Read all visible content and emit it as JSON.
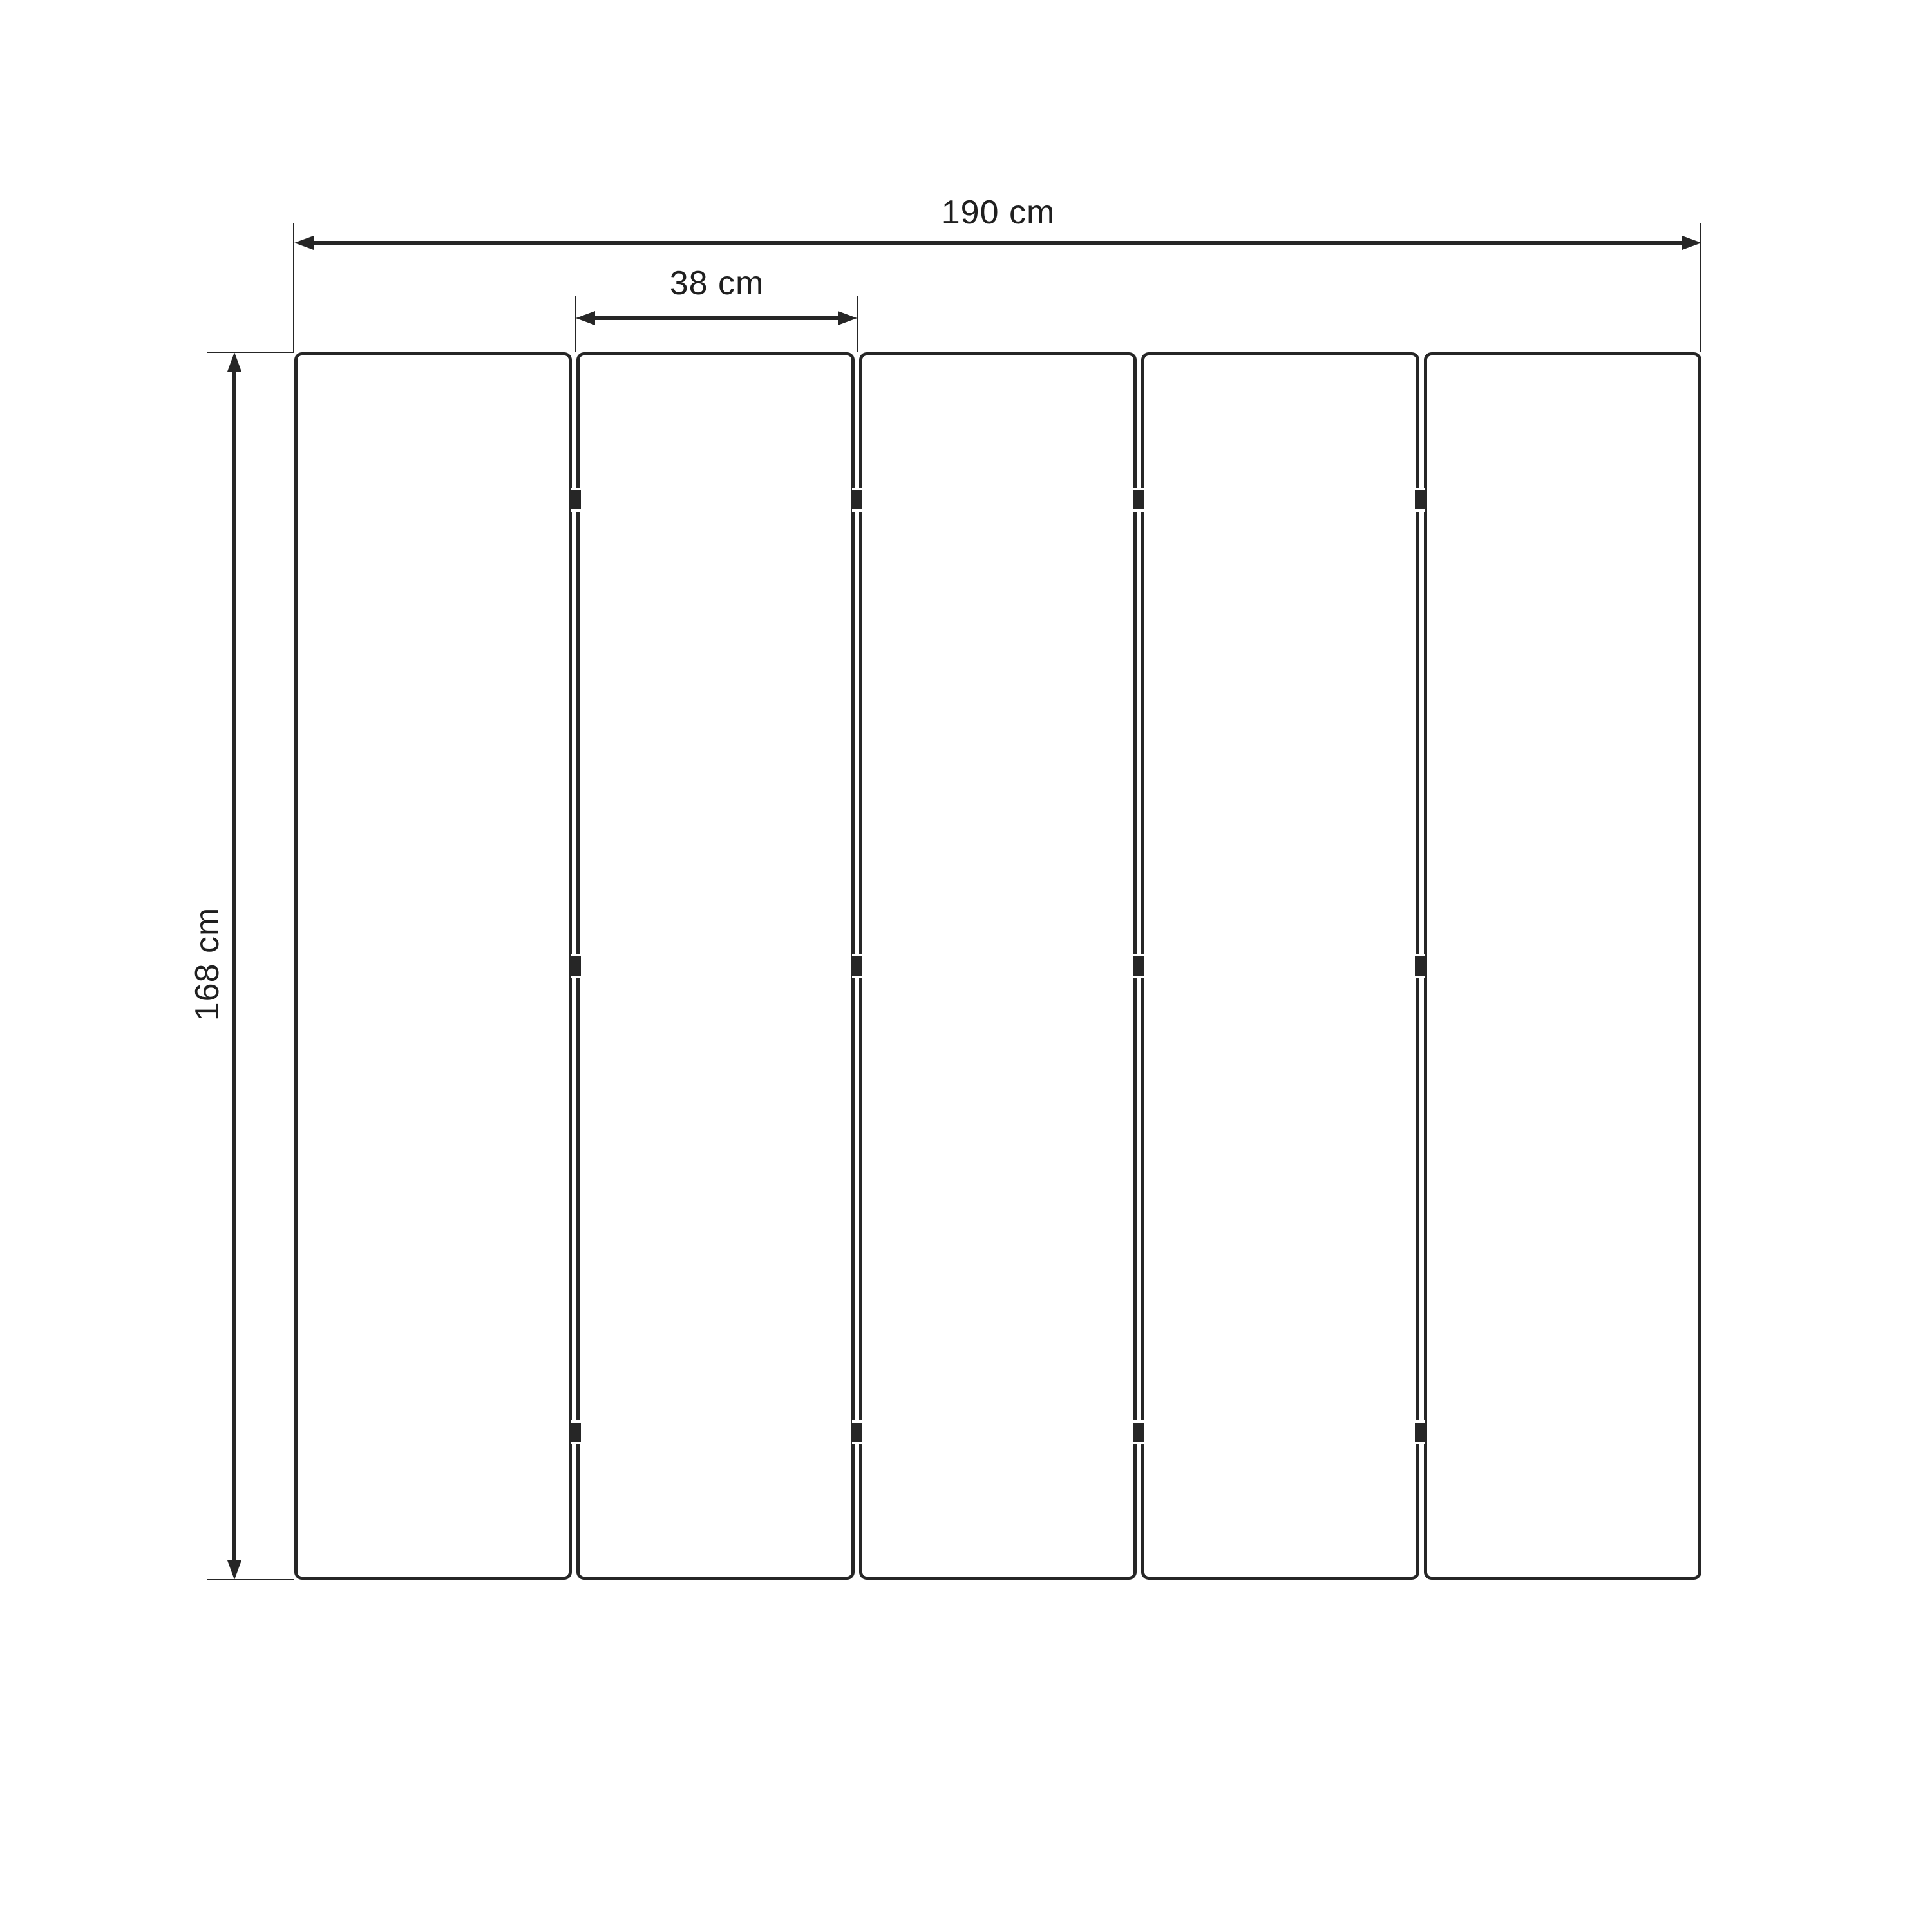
{
  "diagram": {
    "labels": {
      "total_width": "190 cm",
      "panel_width": "38 cm",
      "height": "168 cm"
    },
    "panel_count": 5,
    "hinge_rows": 3,
    "colors": {
      "line": "#262626",
      "text": "#1f1f1f",
      "background": "#ffffff"
    }
  }
}
